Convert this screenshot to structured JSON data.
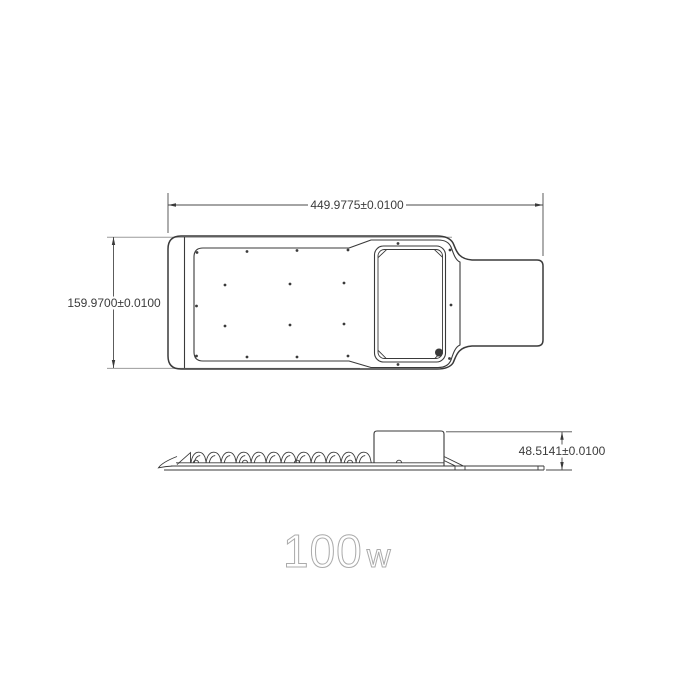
{
  "title": {
    "wattage": "100",
    "unit": "w"
  },
  "drawing": {
    "top_view": {
      "width_dim": "449.9775±0.0100",
      "height_dim": "159.9700±0.0100"
    },
    "side_view": {
      "height_dim": "48.5141±0.0100"
    }
  },
  "colors": {
    "line": "#3a3a3a",
    "ext": "#9c9c9c",
    "dimtext": "#3c3c3c",
    "title": "#ababab",
    "bg": "#ffffff"
  }
}
